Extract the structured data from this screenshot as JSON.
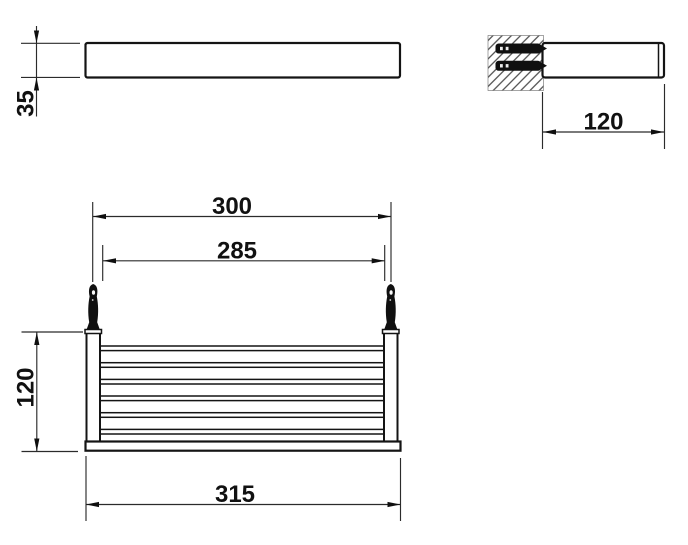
{
  "colors": {
    "background": "#ffffff",
    "object_line": "#141414",
    "dimension_line": "#2b2b2b",
    "text": "#111111"
  },
  "views": {
    "side": {
      "dims": {
        "thickness": "35"
      }
    },
    "section": {
      "dims": {
        "depth": "120"
      },
      "screw_count": 2
    },
    "front": {
      "dims": {
        "hole_spacing": "300",
        "inner_width": "285",
        "height": "120",
        "overall_width": "315"
      },
      "bar_count": 6,
      "hook_count": 2
    }
  }
}
